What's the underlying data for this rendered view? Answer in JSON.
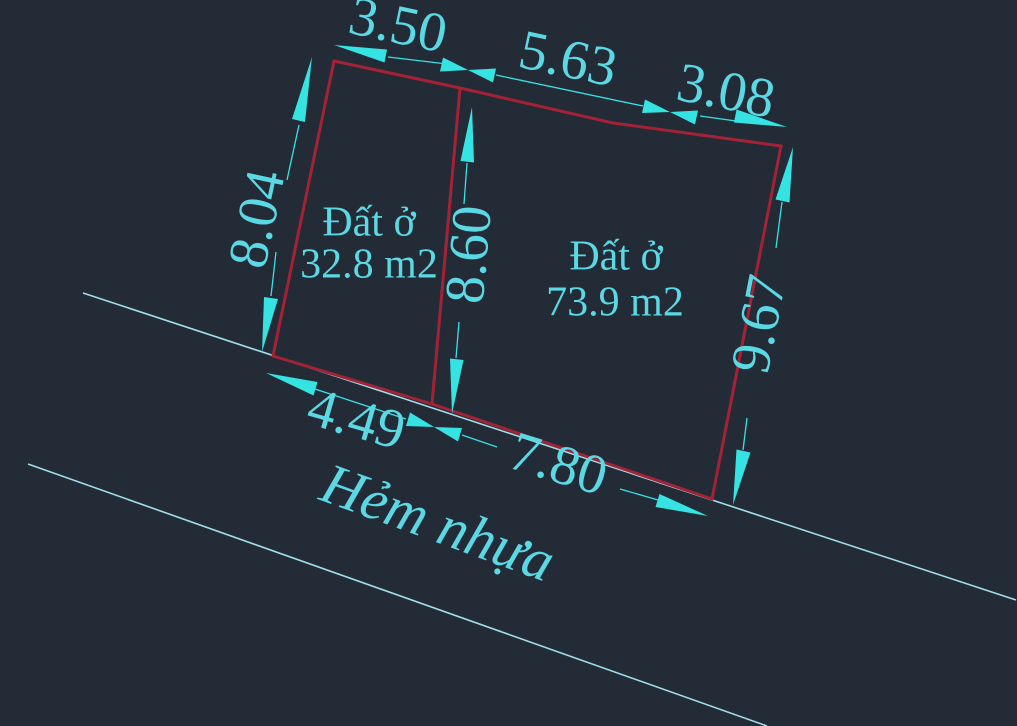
{
  "colors": {
    "background": "#232b37",
    "parcel_line": "#a32235",
    "dimension_accent": "#36e3e3",
    "text_cyan": "#5ad8e4",
    "road_line": "#9fdfe9"
  },
  "parcels": [
    {
      "label": "Đất ở",
      "area": "32.8 m2"
    },
    {
      "label": "Đất ở",
      "area": "73.9 m2"
    }
  ],
  "dimensions": {
    "top_left": "3.50",
    "top_middle": "5.63",
    "top_right": "3.08",
    "left_side": "8.04",
    "divider": "8.60",
    "right_side": "9.67",
    "bottom_left": "4.49",
    "bottom_right": "7.80"
  },
  "road": {
    "label": "Hẻm nhựa"
  }
}
